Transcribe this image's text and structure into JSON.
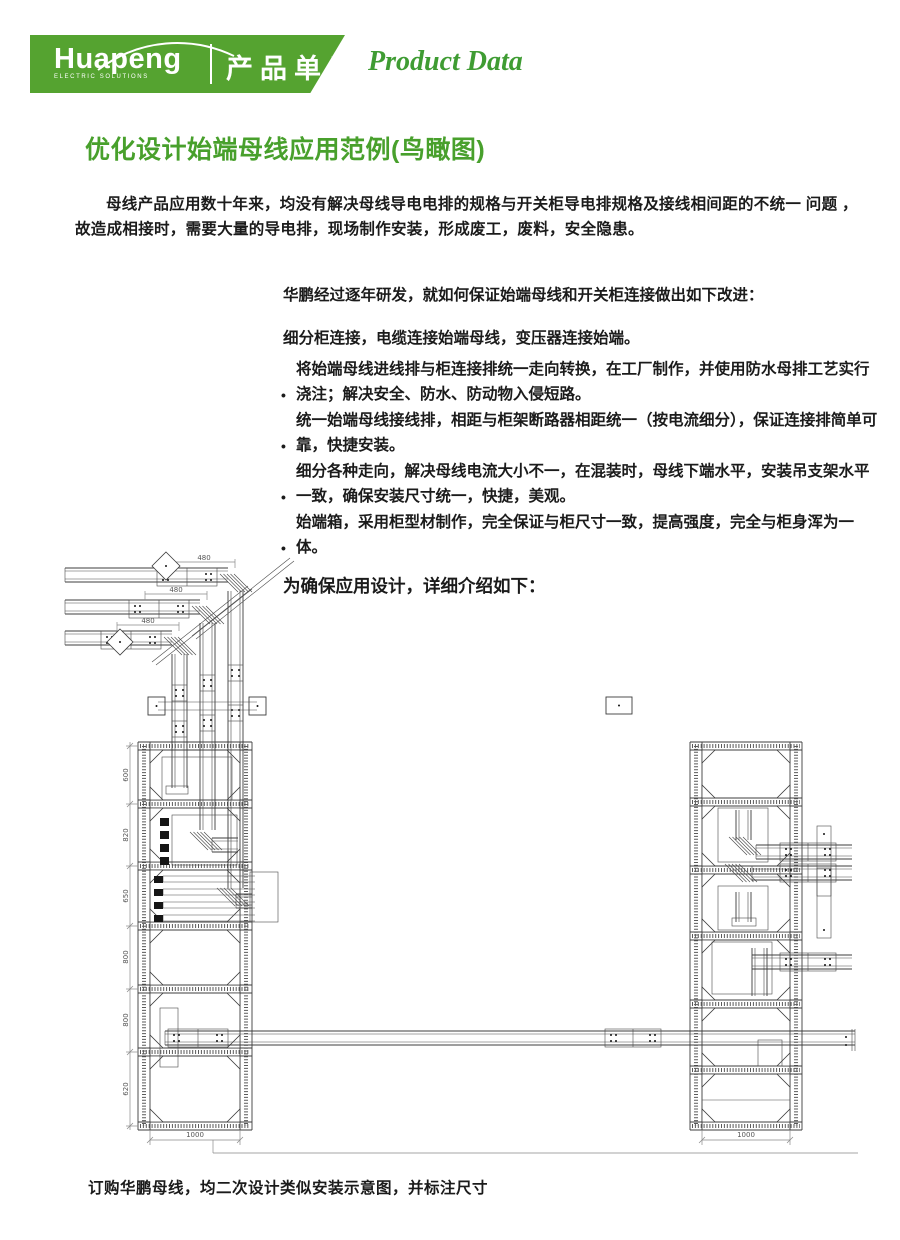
{
  "header": {
    "logo_text": "Huapeng",
    "logo_subtext": "ELECTRIC SOLUTIONS",
    "unit_label": "产品单元",
    "product_data_label": "Product Data"
  },
  "colors": {
    "brand_green": "#55a330",
    "heading_green": "#48a02c",
    "product_data_green": "#3f9c33"
  },
  "content": {
    "title": "优化设计始端母线应用范例(鸟瞰图)",
    "intro": "母线产品应用数十年来，均没有解决母线导电电排的规格与开关柜导电排规格及接线相间距的不统一 问题 ，故造成相接时，需要大量的导电排，现场制作安装，形成废工，废料，安全隐患。",
    "improve_intro": "华鹏经过逐年研发，就如何保证始端母线和开关柜连接做出如下改进：",
    "improve_lead": "细分柜连接，电缆连接始端母线，变压器连接始端。",
    "bullets": [
      "将始端母线进线排与柜连接排统一走向转换，在工厂制作，并使用防水母排工艺实行浇注；解决安全、防水、防动物入侵短路。",
      "统一始端母线接线排，相距与柜架断路器相距统一（按电流细分），保证连接排简单可靠，快捷安装。",
      "细分各种走向，解决母线电流大小不一，在混装时，母线下端水平，安装吊支架水平一致，确保安装尺寸统一，快捷，美观。",
      "始端箱，采用柜型材制作，完全保证与柜尺寸一致，提高强度，完全与柜身浑为一体。"
    ],
    "detail_line": "为确保应用设计，详细介绍如下：",
    "caption": "订购华鹏母线，均二次设计类似安装示意图，并标注尺寸"
  },
  "diagram": {
    "duct_dim_labels": [
      "480",
      "480",
      "480"
    ],
    "left_cabinet_section_labels": [
      "600",
      "820",
      "650",
      "800",
      "800",
      "620"
    ],
    "left_cabinet_width_label": "1000",
    "right_cabinet_width_label": "1000"
  }
}
